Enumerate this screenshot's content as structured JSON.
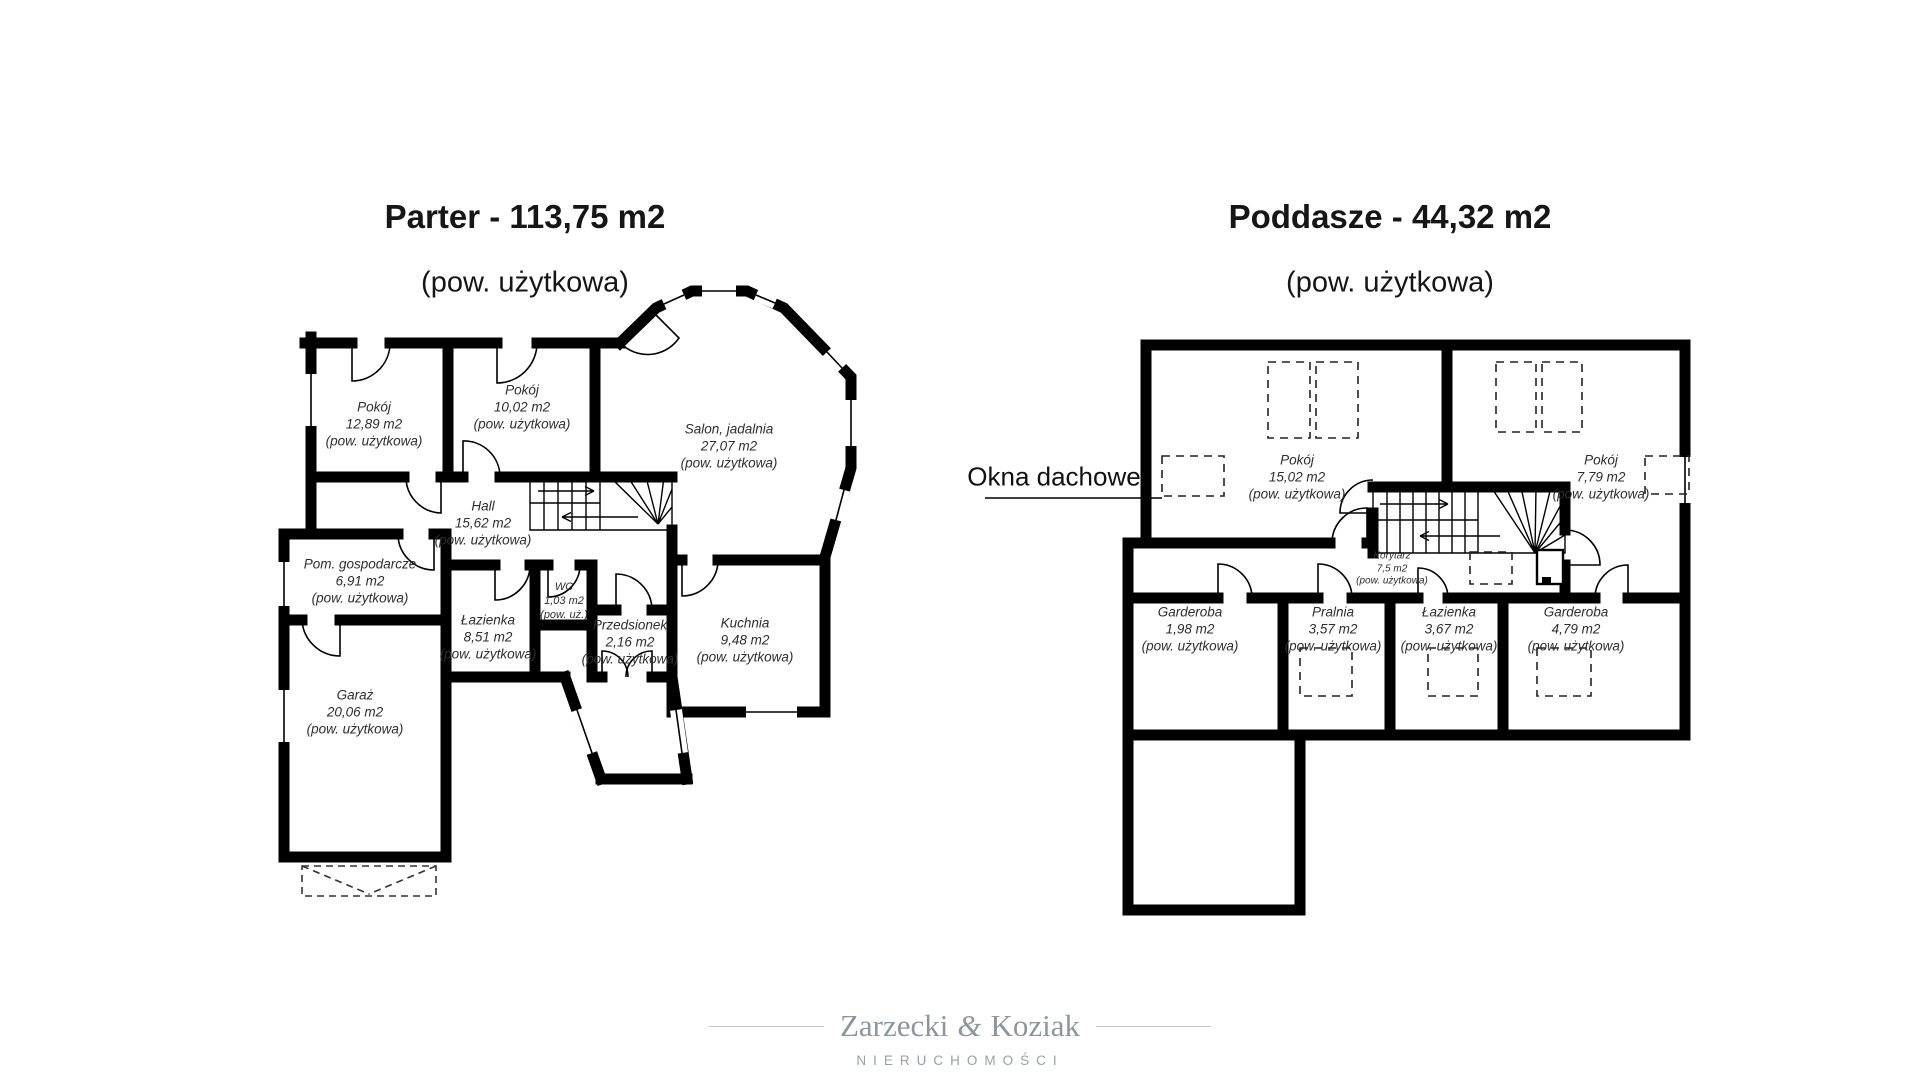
{
  "colors": {
    "wall": "#000000",
    "label_text": "#2e2e2e",
    "watermark_gray": "#8e969d",
    "background": "#ffffff"
  },
  "plans": {
    "parter": {
      "title": "Parter - 113,75 m2",
      "subtitle": "(pow. użytkowa)",
      "rooms": [
        {
          "name": "Pokój",
          "area": "12,89 m2",
          "note": "(pow. użytkowa)"
        },
        {
          "name": "Pokój",
          "area": "10,02 m2",
          "note": "(pow. użytkowa)"
        },
        {
          "name": "Salon, jadalnia",
          "area": "27,07 m2",
          "note": "(pow. użytkowa)"
        },
        {
          "name": "Hall",
          "area": "15,62 m2",
          "note": "(pow. użytkowa)"
        },
        {
          "name": "Pom. gospodarcze",
          "area": "6,91 m2",
          "note": "(pow. użytkowa)"
        },
        {
          "name": "Łazienka",
          "area": "8,51 m2",
          "note": "(pow. użytkowa)"
        },
        {
          "name": "WC",
          "area": "1,03 m2",
          "note": "(pow. uż.)"
        },
        {
          "name": "Przedsionek",
          "area": "2,16 m2",
          "note": "(pow. użytkowa)"
        },
        {
          "name": "Kuchnia",
          "area": "9,48 m2",
          "note": "(pow. użytkowa)"
        },
        {
          "name": "Garaż",
          "area": "20,06 m2",
          "note": "(pow. użytkowa)"
        }
      ]
    },
    "poddasze": {
      "title": "Poddasze - 44,32 m2",
      "subtitle": "(pow. użytkowa)",
      "annotation": "Okna dachowe",
      "rooms": [
        {
          "name": "Pokój",
          "area": "15,02 m2",
          "note": "(pow. użytkowa)"
        },
        {
          "name": "Pokój",
          "area": "7,79 m2",
          "note": "(pow. użytkowa)"
        },
        {
          "name": "Korytarz",
          "area": "7,5 m2",
          "note": "(pow. użytkowa)"
        },
        {
          "name": "Garderoba",
          "area": "1,98 m2",
          "note": "(pow. użytkowa)"
        },
        {
          "name": "Pralnia",
          "area": "3,57 m2",
          "note": "(pow. użytkowa)"
        },
        {
          "name": "Łazienka",
          "area": "3,67 m2",
          "note": "(pow. użytkowa)"
        },
        {
          "name": "Garderoba",
          "area": "4,79 m2",
          "note": "(pow. użytkowa)"
        }
      ]
    }
  },
  "watermark": {
    "name_left": "Zarzecki",
    "ampersand": "&",
    "name_right": "Koziak",
    "tagline": "NIERUCHOMOŚCI"
  }
}
